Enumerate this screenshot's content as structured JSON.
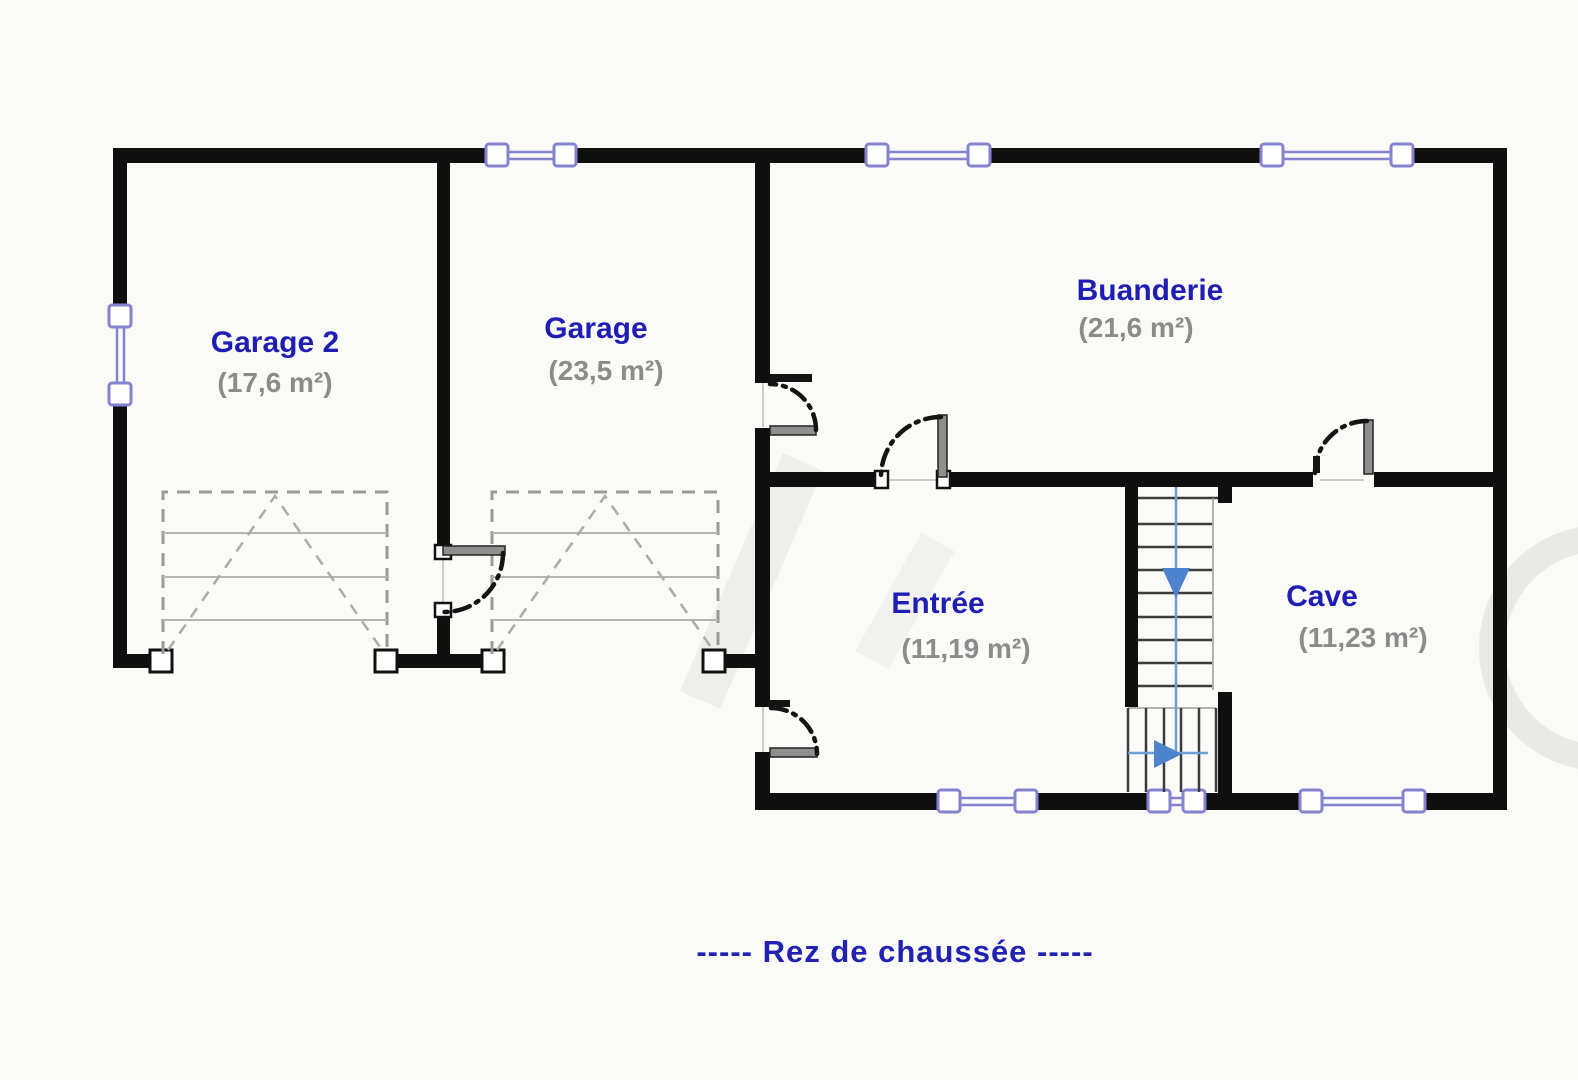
{
  "title": {
    "full": "-----   Rez de chaussée   -----",
    "floor": "Rez de chaussée"
  },
  "rooms": [
    {
      "id": "garage-2",
      "name": "Garage 2",
      "area": "(17,6 m²)"
    },
    {
      "id": "garage",
      "name": "Garage",
      "area": "(23,5 m²)"
    },
    {
      "id": "buanderie",
      "name": "Buanderie",
      "area": "(21,6 m²)"
    },
    {
      "id": "entree",
      "name": "Entrée",
      "area": "(11,19 m²)"
    },
    {
      "id": "cave",
      "name": "Cave",
      "area": "(11,23 m²)"
    }
  ],
  "stairs": {
    "main_flight_direction": "down",
    "lower_flight_direction": "right"
  },
  "colors": {
    "wall": "#0f0f0f",
    "room_name": "#1e1eb4",
    "room_area": "#8b8b8b",
    "window": "#8383cf",
    "stair_route": "#4d82cc",
    "title": "#2121b2"
  }
}
